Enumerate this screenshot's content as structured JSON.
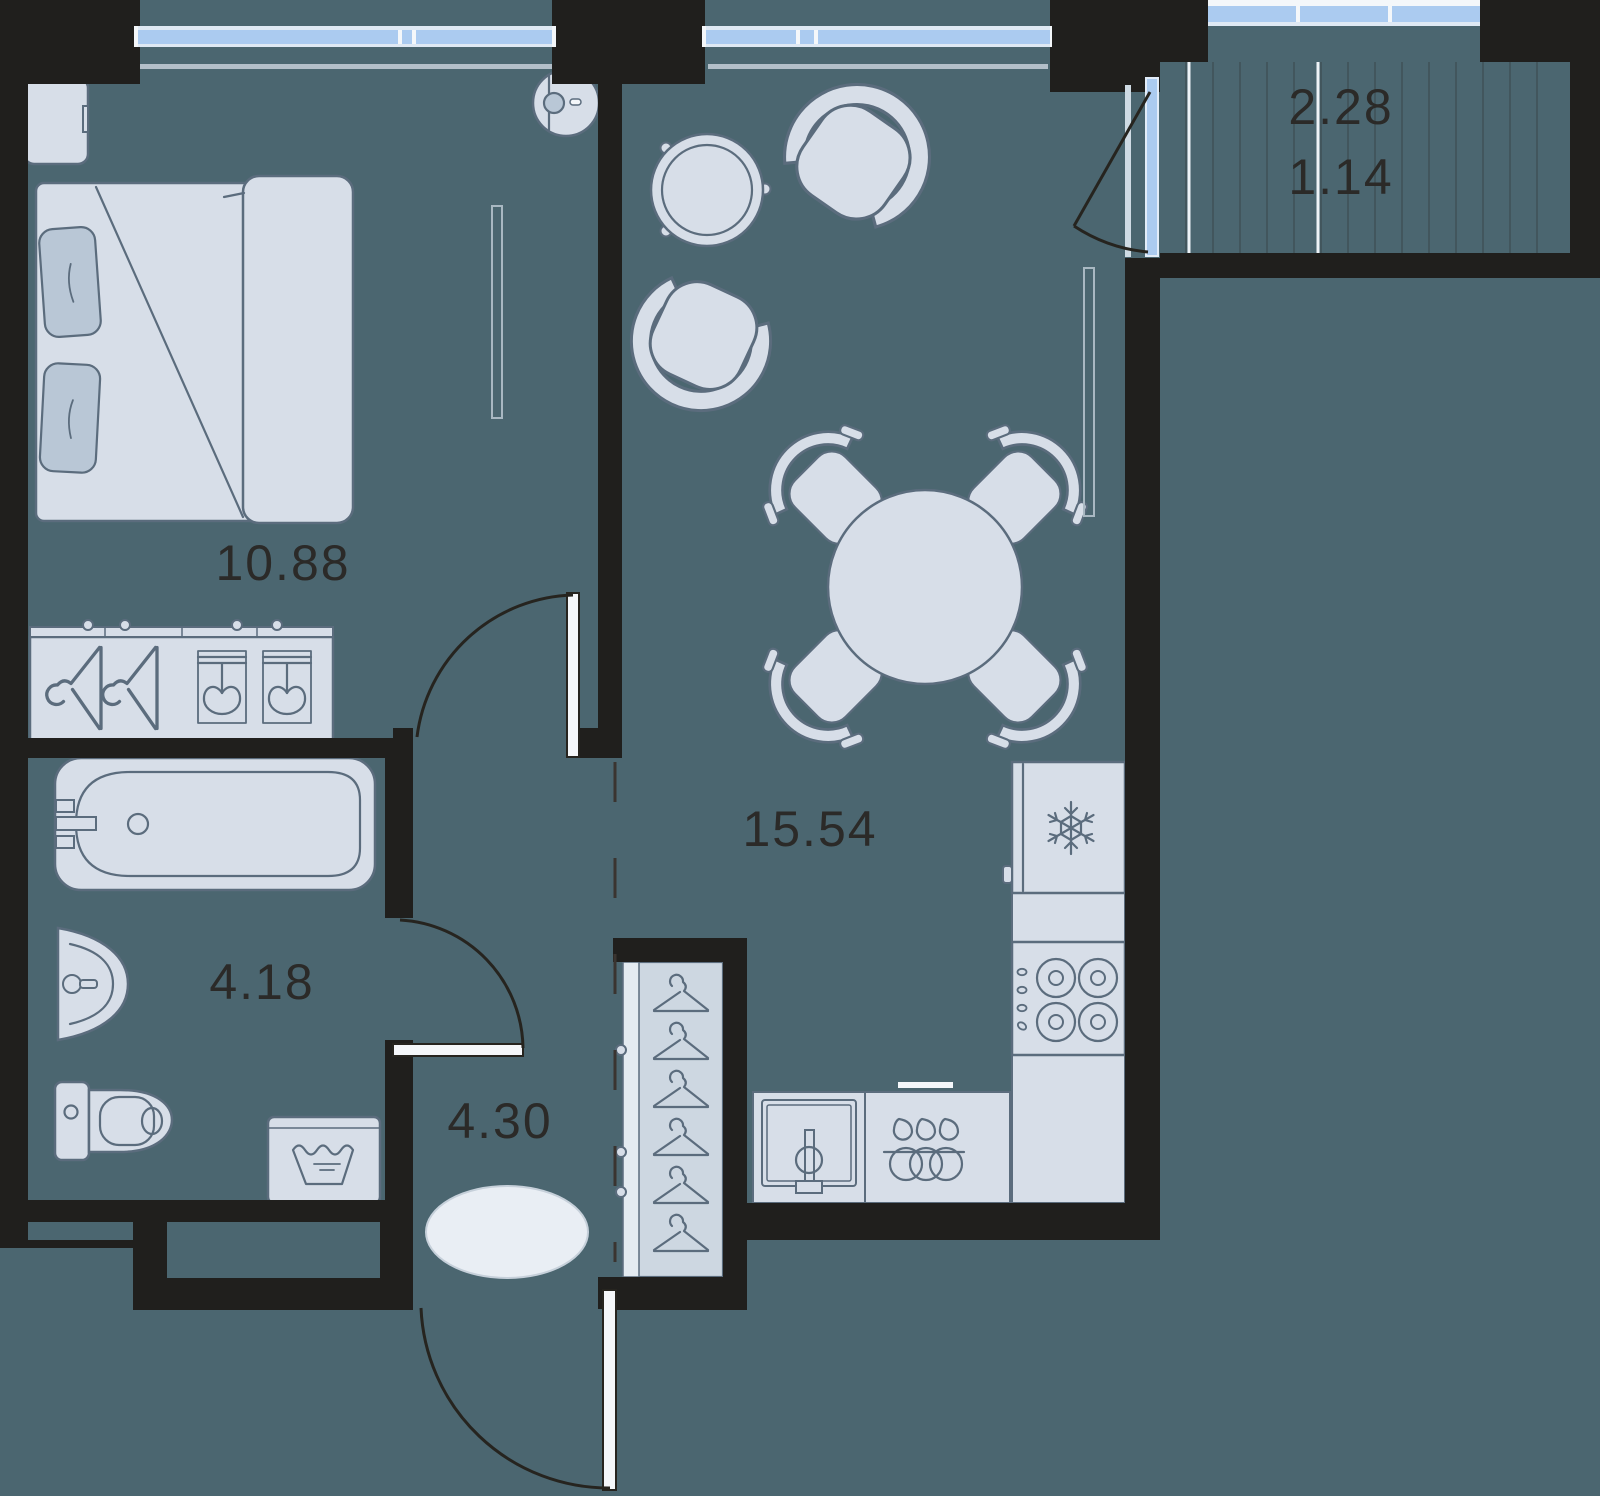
{
  "document": {
    "type": "apartment-floor-plan",
    "style": "top-down 2D plan"
  },
  "labels": {
    "bedroom_area": "10.88",
    "living_kitchen_area": "15.54",
    "bathroom_area": "4.18",
    "hallway_area": "4.30",
    "balcony_area_total": "2.28",
    "balcony_area_reduced": "1.14"
  },
  "rooms": [
    {
      "name": "bedroom",
      "area": "10.88",
      "furniture": [
        "double-bed",
        "nightstand",
        "wardrobe",
        "robot-vacuum",
        "radiator"
      ]
    },
    {
      "name": "living-kitchen",
      "area": "15.54",
      "furniture": [
        "coffee-table",
        "two-armchairs",
        "round-dining-table",
        "four-chairs",
        "fridge",
        "hob",
        "kitchen-sink",
        "dishwasher",
        "counters",
        "radiator"
      ]
    },
    {
      "name": "bathroom",
      "area": "4.18",
      "furniture": [
        "bathtub",
        "washbasin",
        "toilet",
        "washing-machine"
      ]
    },
    {
      "name": "hallway",
      "area": "4.30",
      "furniture": [
        "rug",
        "closet-with-hangers"
      ]
    },
    {
      "name": "balcony",
      "area_total": "2.28",
      "area_reduced": "1.14",
      "furniture": [
        "decking"
      ]
    }
  ],
  "icons": [
    "snowflake-icon",
    "wash-basin-icon",
    "hanger-icon",
    "burner-icon",
    "drop-icon"
  ],
  "colors": {
    "floor": "#4b6670",
    "wall": "#201f1d",
    "furniture_fill": "#d7dee8",
    "furniture_stroke": "#5b6c7d",
    "window_glass": "#abcbf0",
    "label_text": "#2b2a28",
    "rug": "#e9eef4"
  }
}
